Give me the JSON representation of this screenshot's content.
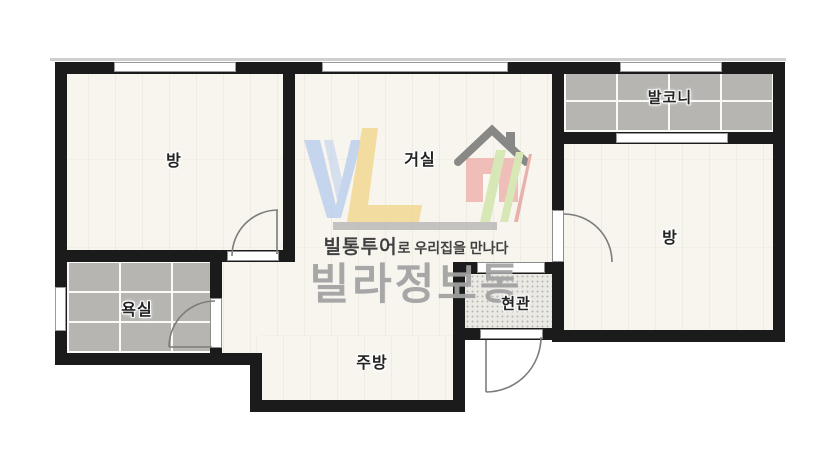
{
  "title": "apartment-floor-plan",
  "rooms": [
    {
      "id": "room-left",
      "label": "방"
    },
    {
      "id": "living",
      "label": "거실"
    },
    {
      "id": "balcony",
      "label": "발코니"
    },
    {
      "id": "room-right",
      "label": "방"
    },
    {
      "id": "bathroom",
      "label": "욕실"
    },
    {
      "id": "kitchen",
      "label": "주방"
    },
    {
      "id": "entrance",
      "label": "현관"
    }
  ],
  "watermark": {
    "logo": "VL-house-logo",
    "tagline_bold": "빌통투어",
    "tagline_rest": "로 우리집을 만나다",
    "brand": "빌라정보통"
  },
  "colors": {
    "wall": "#1b1b1b",
    "floor": "#f7f5ee",
    "tile": "#b6b5b1",
    "entrance_floor": "#ebe9e4",
    "logo_blue": "#b9cdee",
    "logo_yellow": "#f3d68c",
    "logo_green": "#cfe3a6",
    "logo_red": "#eeb0ab",
    "brand_gray": "#a2a2a2"
  }
}
